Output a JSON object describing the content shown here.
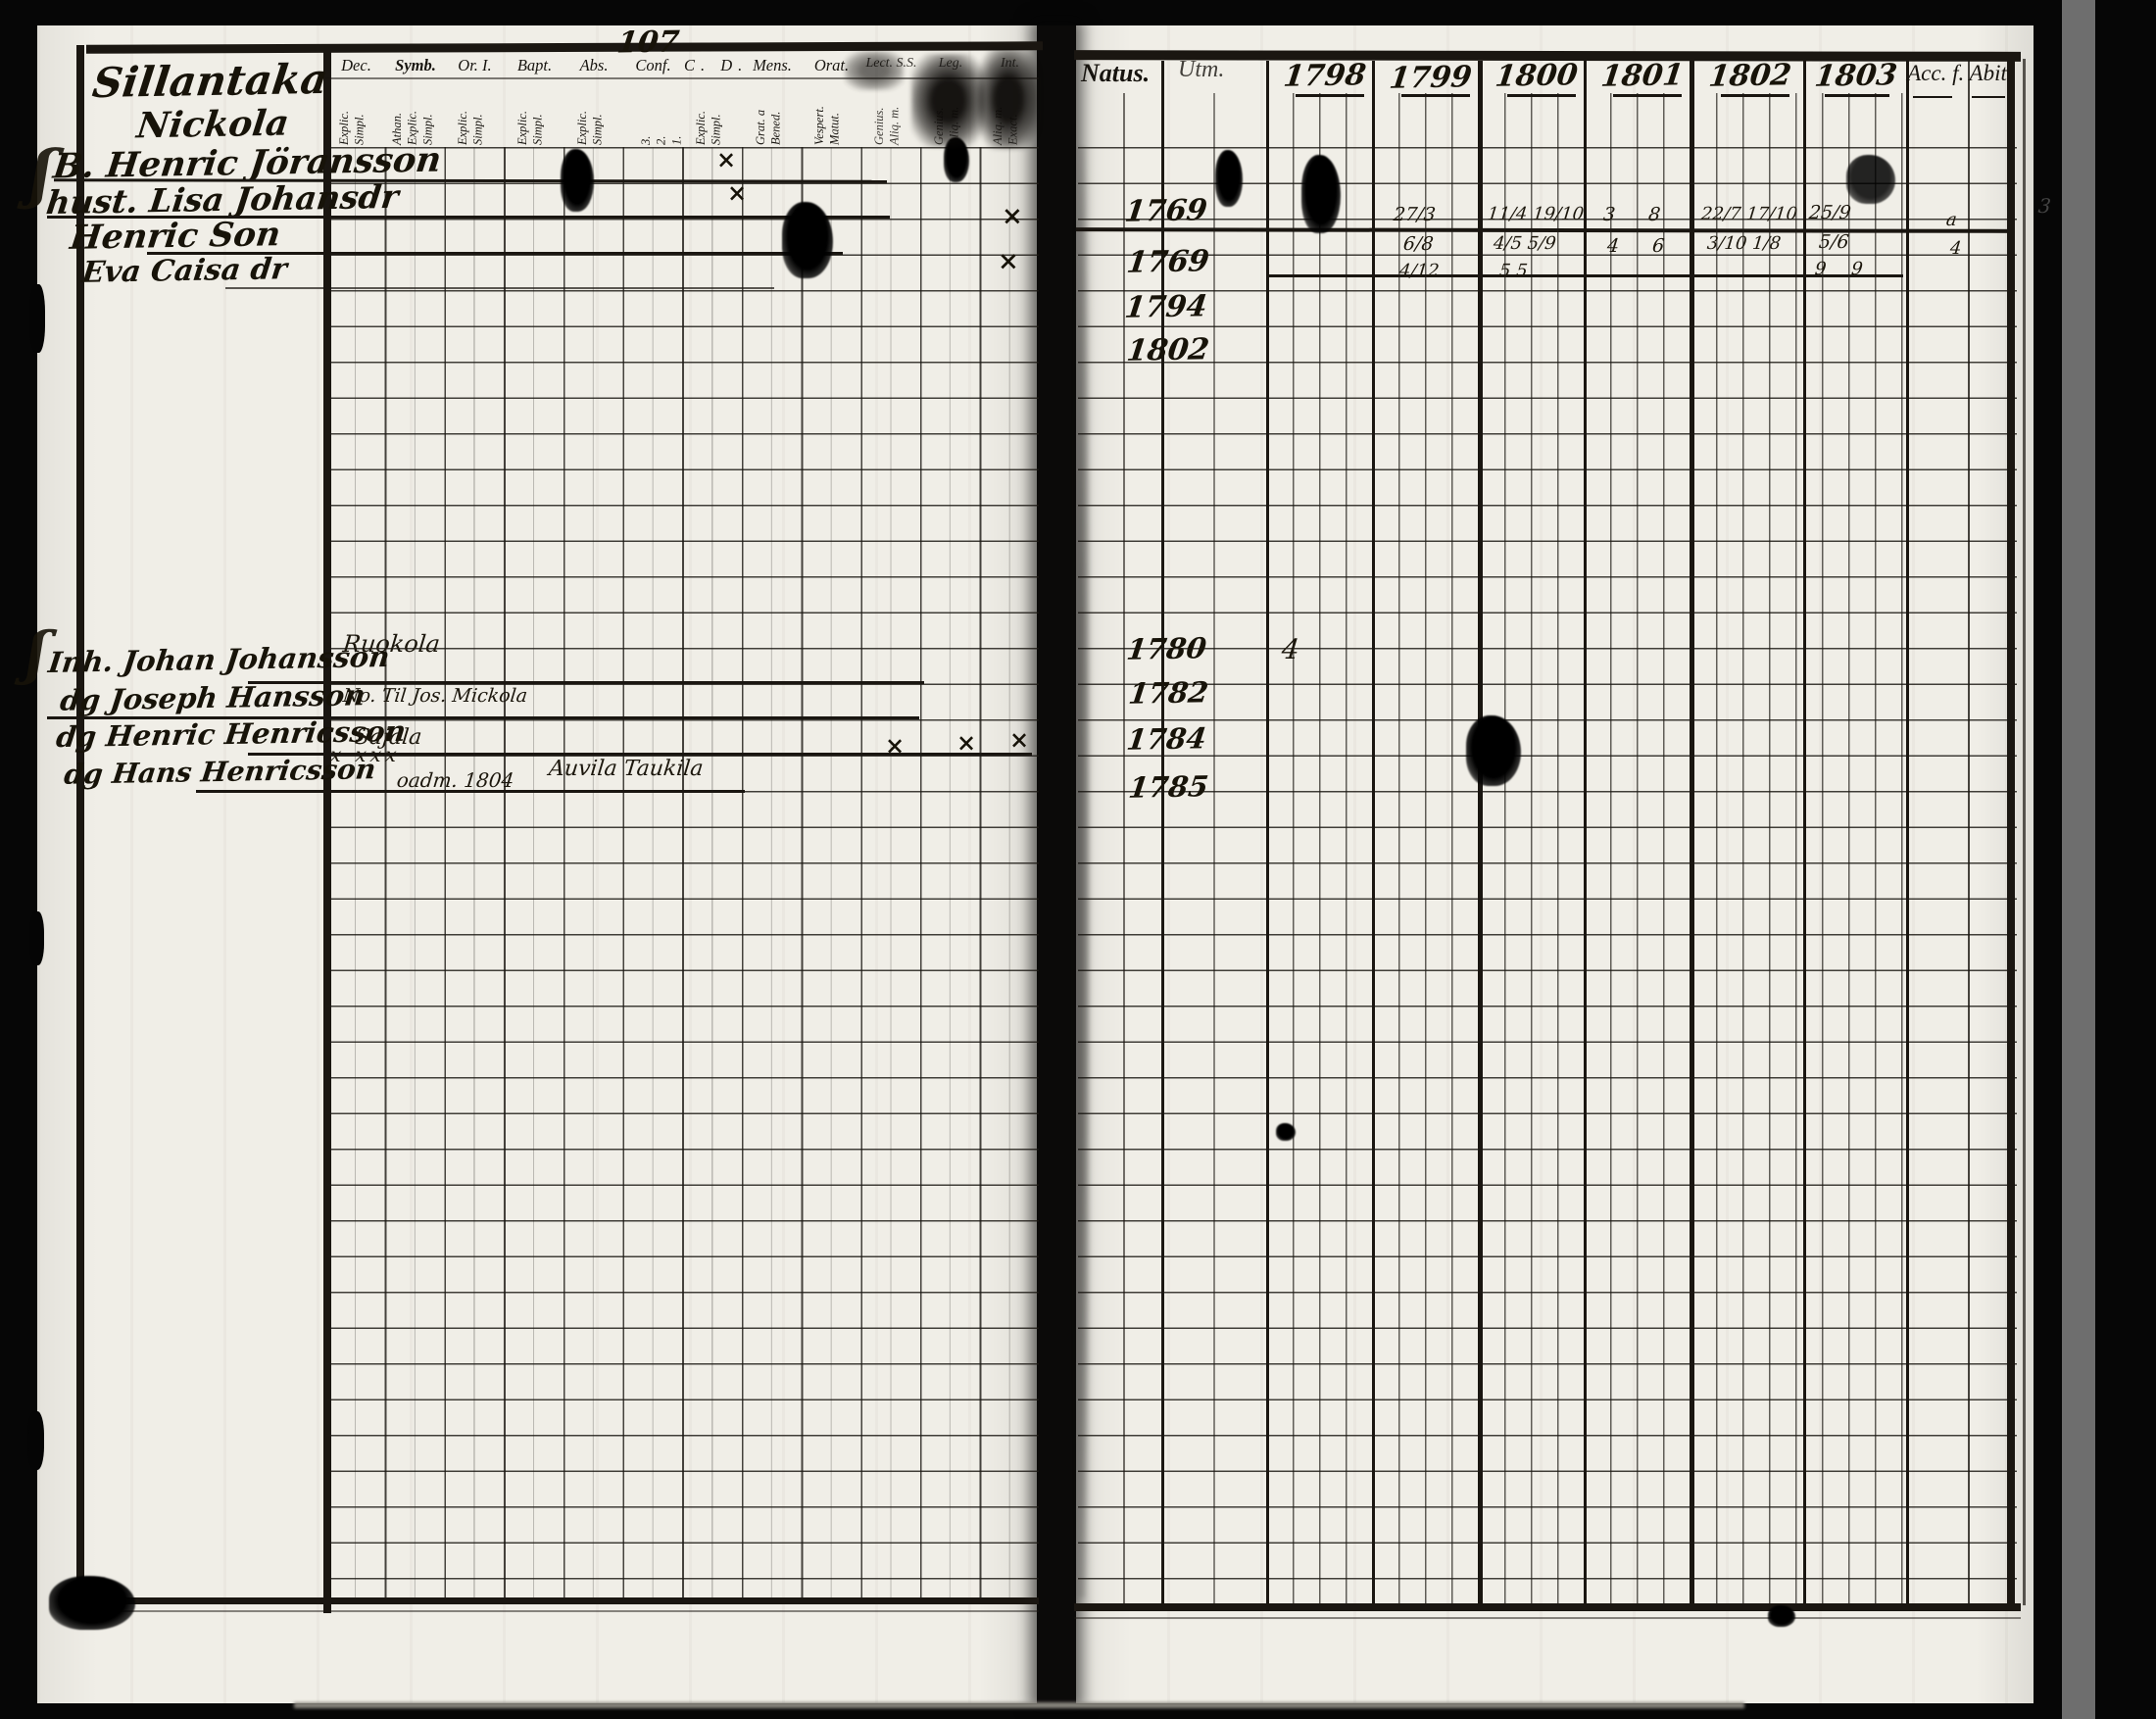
{
  "scan": {
    "page_number": "107",
    "edge_mark": "3"
  },
  "glyphs": {
    "cross": "×",
    "brace": "ʃ"
  },
  "left_page": {
    "title": {
      "line1": "Sillantaka",
      "line2": "Nickola"
    },
    "columns": [
      {
        "label": "Dec.",
        "sub": "Explic.\nSimpl."
      },
      {
        "label": "Symb.",
        "sub": "Athan.\nExplic.\nSimpl."
      },
      {
        "label": "Or. I.",
        "sub": "Explic.\nSimpl."
      },
      {
        "label": "Bapt.",
        "sub": "Explic.\nSimpl."
      },
      {
        "label": "Abs.",
        "sub": "Explic.\nSimpl."
      },
      {
        "label": "Conf.",
        "sub": "3.\n2.\n1."
      },
      {
        "label": "C.  D.",
        "sub": "Explic.\nSimpl."
      },
      {
        "label": "Mens.",
        "sub": "Grat. a\nBened."
      },
      {
        "label": "Orat.",
        "sub": "Vespert.\nMatut."
      },
      {
        "label": "Lect. S.S.",
        "sub": "Genius.\nAliq. m."
      },
      {
        "label": "Leg.",
        "sub": "Genius.\nAliq. m."
      },
      {
        "label": "Int.",
        "sub": "Aliq. m.\nExact."
      }
    ]
  },
  "families": [
    {
      "members": [
        {
          "name": "B. Henric Jöransson",
          "natus": "1769"
        },
        {
          "name": "hust. Lisa Johansdr",
          "natus": "1769"
        },
        {
          "name": "Henric Son",
          "natus": "1794"
        },
        {
          "name": "Eva Caisa dr",
          "natus": "1802"
        }
      ]
    },
    {
      "members": [
        {
          "name": "Inh. Johan Johansson",
          "annotation": "Ruokola",
          "natus": "1780"
        },
        {
          "name": "dg Joseph Hansson",
          "annotation": "No. Til Jos. Mickola",
          "natus": "1782"
        },
        {
          "name": "dg Henric Henricsson",
          "annotation": "Sajala",
          "annotation2": "x xxx",
          "natus": "1784"
        },
        {
          "name": "dg Hans Henricsson",
          "annotation": "oadm. 1804",
          "annotation2": "Auvila Taukila",
          "natus": "1785"
        }
      ]
    }
  ],
  "right_page": {
    "natus_header": "Natus.",
    "utm_header": "Utm.",
    "years": [
      "1798",
      "1799",
      "1800",
      "1801",
      "1802",
      "1803"
    ],
    "acc_header": "Acc. f. Abit",
    "communion_marks": [
      {
        "year": "1798",
        "lines": [
          "7",
          "",
          ""
        ]
      },
      {
        "year": "1799",
        "lines": [
          "27/3",
          "6/8",
          "4/12"
        ]
      },
      {
        "year": "1800",
        "lines": [
          "11/4 19/10",
          "4/5 5/9",
          "5 5"
        ]
      },
      {
        "year": "1801",
        "lines": [
          "3 8",
          "4 6",
          ""
        ]
      },
      {
        "year": "1802",
        "lines": [
          "22/7 17/10",
          "3/10 1/8",
          ""
        ]
      },
      {
        "year": "1803",
        "lines": [
          "25/9",
          "5/6",
          "9 9"
        ]
      }
    ],
    "block2_marks": [
      "4"
    ],
    "acc_marks": [
      "a",
      "4"
    ]
  }
}
